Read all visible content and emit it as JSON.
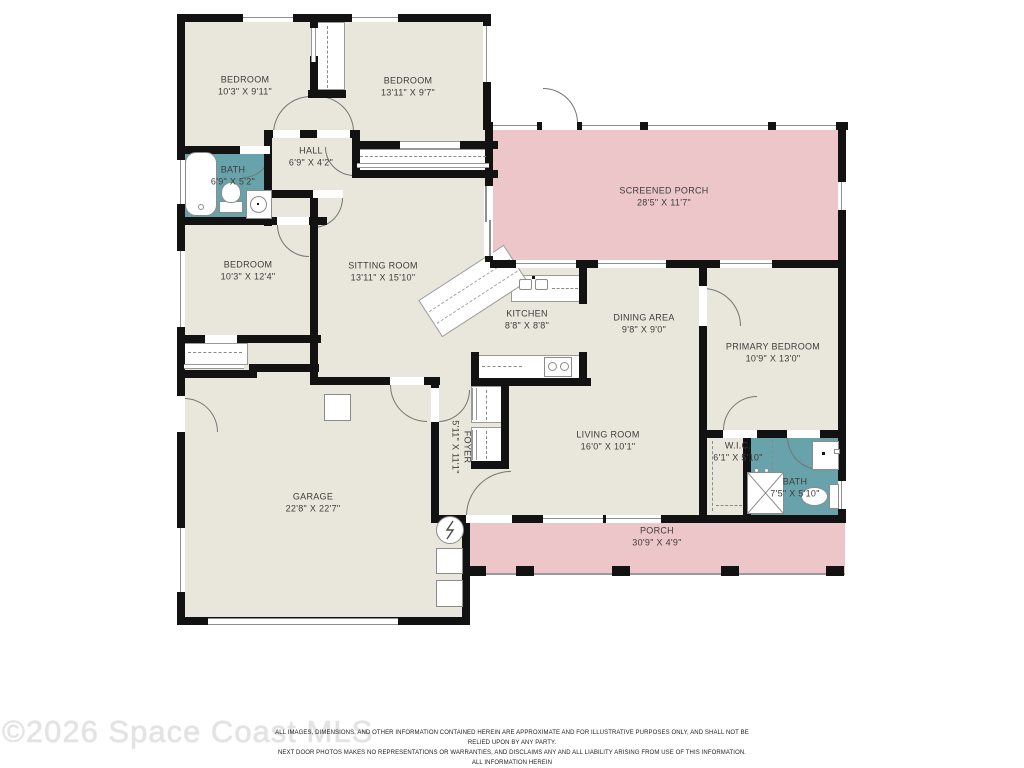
{
  "watermark": "©2026 Space Coast MLS",
  "disclaimer": {
    "line1": "ALL IMAGES, DIMENSIONS, AND OTHER INFORMATION CONTAINED HEREIN ARE APPROXIMATE AND FOR ILLUSTRATIVE PURPOSES ONLY, AND SHALL NOT BE RELIED UPON BY ANY PARTY.",
    "line2": "NEXT DOOR PHOTOS MAKES NO REPRESENTATIONS OR WARRANTIES, AND DISCLAIMS ANY AND ALL LIABILITY ARISING FROM USE OF THIS INFORMATION. ALL INFORMATION HEREIN",
    "line3": "SHALL BE SUBJECT TO THE TERMS AND CONDITIONS FOUND AT NEXTDOORPHOTOS.COM/TC."
  },
  "colors": {
    "room_fill": "#e9e6db",
    "porch_fill": "#edc6c9",
    "bath_fill": "#68a2aa",
    "wall": "#121212"
  },
  "rooms": {
    "bedroom1": {
      "name": "BEDROOM",
      "dims": "10'3\" X 9'11\""
    },
    "bedroom2": {
      "name": "BEDROOM",
      "dims": "13'11\" X 9'7\""
    },
    "hall": {
      "name": "HALL",
      "dims": "6'9\" X 4'2\""
    },
    "bath1": {
      "name": "BATH",
      "dims": "6'9\" X 5'2\""
    },
    "screened_porch": {
      "name": "SCREENED PORCH",
      "dims": "28'5\" X 11'7\""
    },
    "bedroom3": {
      "name": "BEDROOM",
      "dims": "10'3\" X 12'4\""
    },
    "sitting_room": {
      "name": "SITTING ROOM",
      "dims": "13'11\" X 15'10\""
    },
    "kitchen": {
      "name": "KITCHEN",
      "dims": "8'8\" X 8'8\""
    },
    "dining_area": {
      "name": "DINING AREA",
      "dims": "9'8\" X 9'0\""
    },
    "primary_bedroom": {
      "name": "PRIMARY BEDROOM",
      "dims": "10'9\" X 13'0\""
    },
    "foyer": {
      "name": "FOYER",
      "dims": "5'11\" X 11'1\""
    },
    "living_room": {
      "name": "LIVING ROOM",
      "dims": "16'0\" X 10'1\""
    },
    "wic": {
      "name": "W.I.C.",
      "dims": "6'1\" X 5'10\""
    },
    "bath2": {
      "name": "BATH",
      "dims": "7'5\" X 5'10\""
    },
    "garage": {
      "name": "GARAGE",
      "dims": "22'8\" X 22'7\""
    },
    "porch": {
      "name": "PORCH",
      "dims": "30'9\" X 4'9\""
    }
  }
}
